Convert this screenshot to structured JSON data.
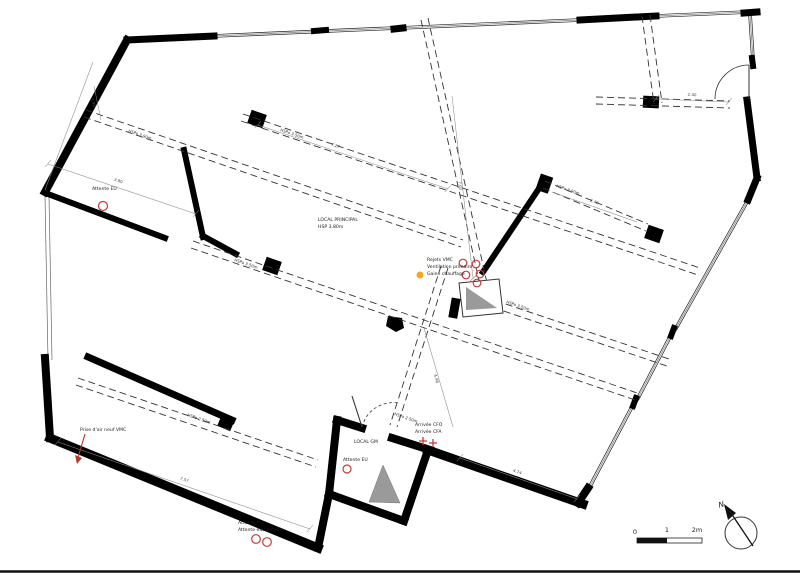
{
  "plan": {
    "rooms": {
      "principal_name": "LOCAL PRINCIPAL",
      "principal_height": "HSP 3.80m",
      "gm_name": "LOCAL GM"
    },
    "annotations": {
      "rejets_vmc": "Rejets VMC",
      "ventilation_primaire": "Ventilation primaire",
      "gaine_chauffage": "Gaine chauffage",
      "attente_eu_top": "Attente EU",
      "attente_eu_gm": "Attente EU",
      "attente_eu_bottom": "Attente EU",
      "attente_eau_potable": "Attente eau potable",
      "arrivee_cfo": "Arrivée CFO",
      "arrivee_cfa": "Arrivée CFA",
      "prise_air_neuf": "Prise d'air neuf VMC"
    },
    "beam_labels": {
      "beam1": "HSPo 3.90m",
      "beam2": "HSPo 3.50m",
      "beam3": "HSPo 3.50m",
      "beam4": "HSPo 3.50m",
      "beam5": "HSPo 3.90m",
      "beam6": "HSPo 2.50m",
      "beam7": "HSPo 2.50m"
    },
    "dimensions": {
      "room_tl_width": "3.80",
      "room_tl_depth": "1.98",
      "beam_span": "7.27",
      "center_span": "7.03",
      "bay_width": "2.40",
      "right_span": "2.42",
      "bottom_right_span": "4.74",
      "gm_span": "4.48",
      "wing_length": "7.57"
    },
    "scale_bar": {
      "zero": "0",
      "one": "1",
      "two": "2m"
    },
    "north_label": "N",
    "colors": {
      "marker_red": "#c23b3b",
      "marker_orange": "#f5a623",
      "duct_gray": "#9a9a9a",
      "wall_black": "#000000"
    }
  }
}
